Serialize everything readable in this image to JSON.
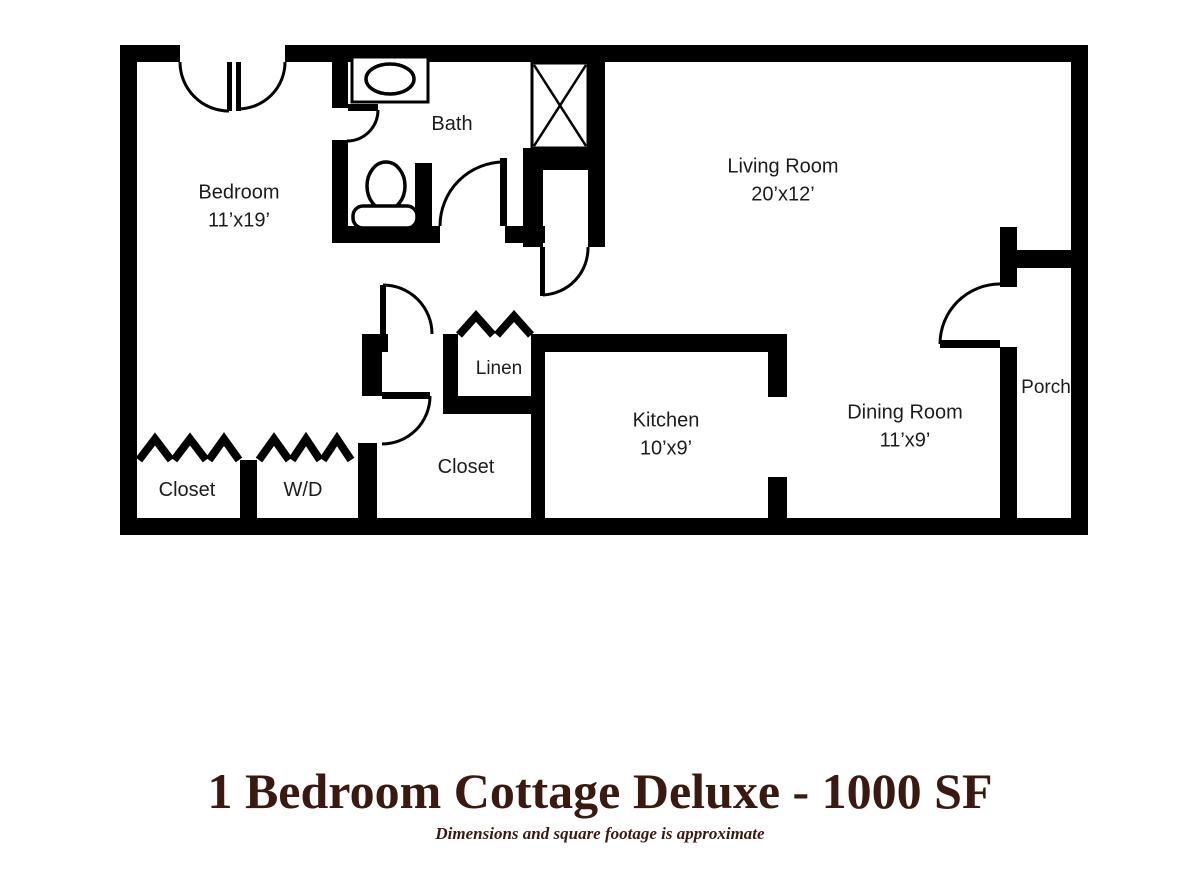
{
  "title": {
    "heading": "1 Bedroom Cottage Deluxe - 1000 SF",
    "note": "Dimensions and square footage is approximate"
  },
  "colors": {
    "wall": "#000000",
    "background": "#ffffff",
    "title_text": "#3a1a10",
    "label_text": "#1c1c1c"
  },
  "rooms": {
    "bedroom": {
      "name": "Bedroom",
      "dims": "11’x19’"
    },
    "bath": {
      "name": "Bath"
    },
    "living": {
      "name": "Living Room",
      "dims": "20’x12’"
    },
    "linen": {
      "name": "Linen"
    },
    "hall_closet": {
      "name": "Closet"
    },
    "kitchen": {
      "name": "Kitchen",
      "dims": "10’x9’"
    },
    "dining": {
      "name": "Dining Room",
      "dims": "11’x9’"
    },
    "porch": {
      "name": "Porch"
    },
    "bedroom_closet": {
      "name": "Closet"
    },
    "wd": {
      "name": "W/D"
    }
  }
}
